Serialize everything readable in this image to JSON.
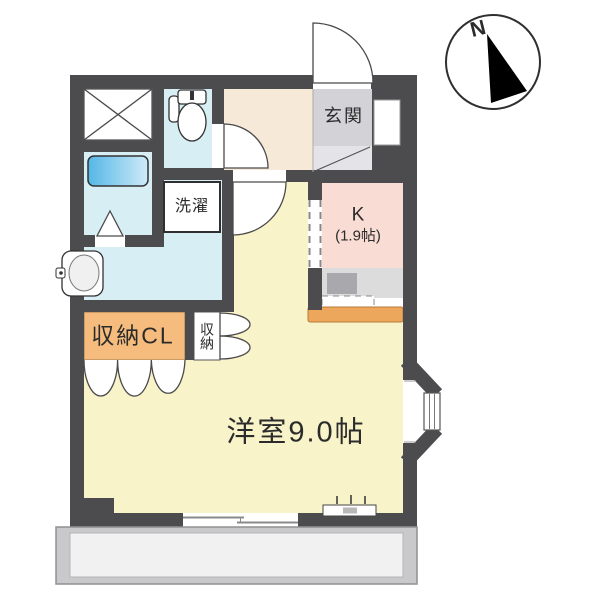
{
  "compass": {
    "north_label": "N"
  },
  "rooms": {
    "genkan": {
      "label": "玄関"
    },
    "kitchen": {
      "label": "K",
      "size": "(1.9帖)"
    },
    "laundry": {
      "label": "洗濯"
    },
    "closet": {
      "label": "収納CL"
    },
    "storage": {
      "label": "収納"
    },
    "main_room": {
      "label": "洋室9.0帖"
    }
  },
  "colors": {
    "wall": "#4c4c4e",
    "main_room": "#f9f3c9",
    "kitchen": "#f9dcd3",
    "hall": "#f6e9d8",
    "water_rooms": "#d8eef5",
    "tub_dark": "#54b7e6",
    "tub_light": "#cfeaf8",
    "genkan": "#d3d3d7",
    "genkan_step": "#e4e4e8",
    "closet": "#f6bc7e",
    "counter_bar": "#eda75c",
    "counter": "#dcdcdc",
    "balcony": "#c9c9cb",
    "balcony_floor": "#f1f1f2"
  }
}
